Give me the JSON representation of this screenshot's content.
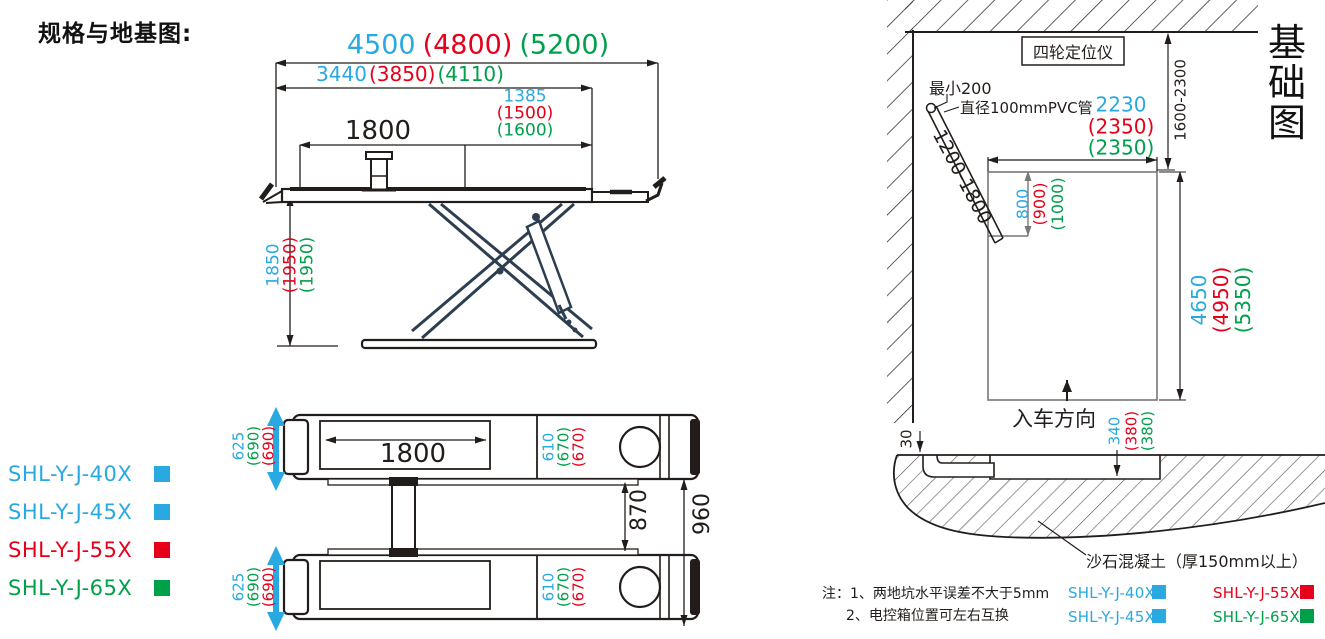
{
  "sheet_title": "规格与地基图:",
  "colors": {
    "blue": "#29A9E1",
    "red": "#E60019",
    "green": "#00A04B",
    "line": "#221d1a",
    "scissor": "#2C3E50"
  },
  "side_view": {
    "dim_total_length": {
      "v40": "4500",
      "v55": "(4800)",
      "v65": "(5200)"
    },
    "dim_platform_length": {
      "v40": "3440",
      "v55": "(3850)",
      "v65": "(4110)"
    },
    "dim_right_section": {
      "v40": "1385",
      "v55": "(1500)",
      "v65": "(1600)"
    },
    "dim_recess_length": "1800",
    "dim_lift_height": {
      "v40": "1850",
      "v55": "(1950)",
      "v65": "(1950)"
    }
  },
  "plan_view": {
    "dim_recess_length": "1800",
    "dim_platform_width": {
      "v40": "625",
      "v65": "(690)",
      "v55": "(690)"
    },
    "dim_tread_width": {
      "v40": "610",
      "v65": "(670)",
      "v55": "(670)"
    },
    "dim_inner_gap": "870",
    "dim_outer_gap": "960"
  },
  "models": [
    {
      "label": "SHL-Y-J-40X",
      "color": "blue"
    },
    {
      "label": "SHL-Y-J-45X",
      "color": "blue"
    },
    {
      "label": "SHL-Y-J-55X",
      "color": "red"
    },
    {
      "label": "SHL-Y-J-65X",
      "color": "green"
    }
  ],
  "foundation": {
    "title_vertical": "基础图",
    "title_chars": {
      "c1": "基",
      "c2": "础",
      "c3": "图"
    },
    "aligner_label": "四轮定位仪",
    "min_clearance": "最小200",
    "pvc_pipe_label": "直径100mmPVC管",
    "pipe_depth_range": "1200-1800",
    "wall_distance_range": "1600-2300",
    "dim_pit_width": {
      "v40": "2230",
      "v55": "(2350)",
      "v65": "(2350)"
    },
    "dim_notch": {
      "v40": "800",
      "v55": "(900)",
      "v65": "(1000)"
    },
    "dim_pit_length": {
      "v40": "4650",
      "v55": "(4950)",
      "v65": "(5350)"
    },
    "dim_pit_depth": {
      "v40": "340",
      "v55": "(380)",
      "v65": "(380)"
    },
    "dim_edge_gap": "30",
    "entry_direction_label": "入车方向",
    "concrete_label": "沙石混凝土（厚150mm以上）",
    "note_line1": "注：1、两地坑水平误差不大于5mm",
    "note_line2": "2、电控箱位置可左右互换",
    "legend": [
      {
        "label": "SHL-Y-J-40X",
        "color": "blue"
      },
      {
        "label": "SHL-Y-J-55X",
        "color": "red"
      },
      {
        "label": "SHL-Y-J-45X",
        "color": "blue"
      },
      {
        "label": "SHL-Y-J-65X",
        "color": "green"
      }
    ]
  }
}
